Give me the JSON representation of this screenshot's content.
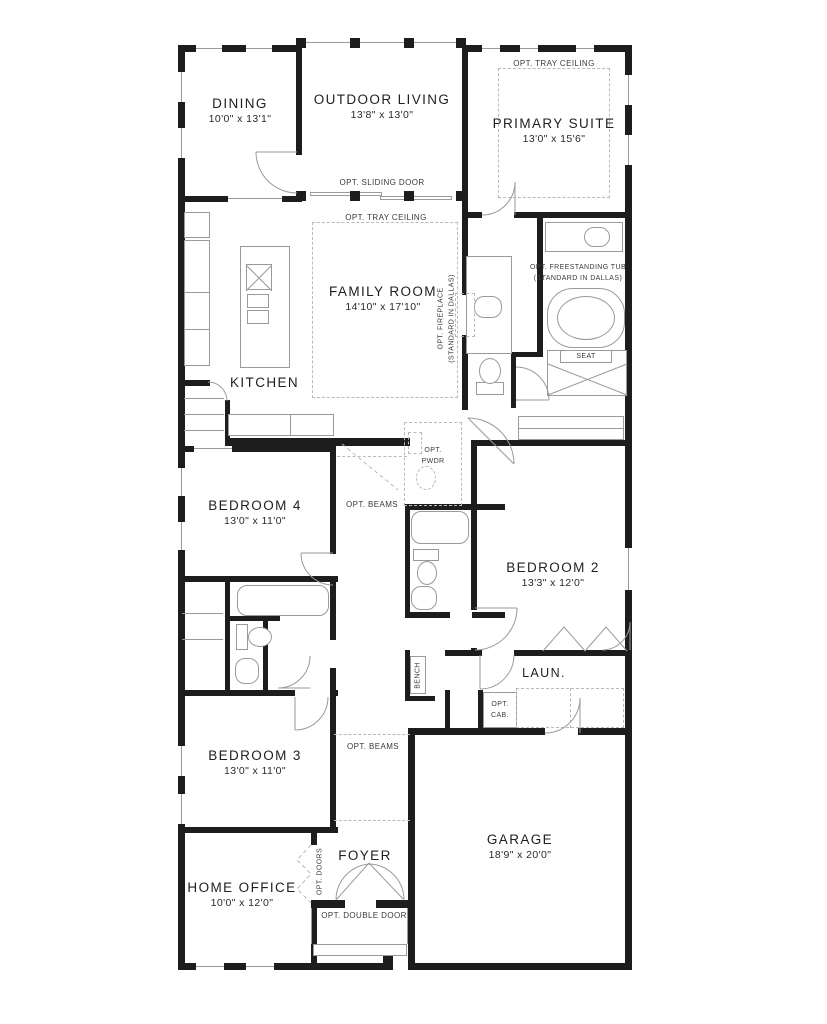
{
  "plan": {
    "rooms": {
      "dining": {
        "name": "DINING",
        "dims": "10'0\" x 13'1\""
      },
      "outdoor_living": {
        "name": "OUTDOOR LIVING",
        "dims": "13'8\" x 13'0\""
      },
      "primary_suite": {
        "name": "PRIMARY SUITE",
        "dims": "13'0\" x 15'6\""
      },
      "family_room": {
        "name": "FAMILY ROOM",
        "dims": "14'10\" x 17'10\""
      },
      "kitchen": {
        "name": "KITCHEN"
      },
      "bedroom4": {
        "name": "BEDROOM 4",
        "dims": "13'0\" x 11'0\""
      },
      "bedroom2": {
        "name": "BEDROOM 2",
        "dims": "13'3\" x 12'0\""
      },
      "bedroom3": {
        "name": "BEDROOM 3",
        "dims": "13'0\" x 11'0\""
      },
      "laundry": {
        "name": "LAUN."
      },
      "foyer": {
        "name": "FOYER"
      },
      "home_office": {
        "name": "HOME OFFICE",
        "dims": "10'0\" x 12'0\""
      },
      "garage": {
        "name": "GARAGE",
        "dims": "18'9\" x 20'0\""
      }
    },
    "annotations": {
      "tray_primary": "OPT. TRAY CEILING",
      "tray_family": "OPT. TRAY CEILING",
      "sliding_door": "OPT. SLIDING DOOR",
      "fireplace_line1": "OPT. FIREPLACE",
      "fireplace_line2": "(STANDARD IN DALLAS)",
      "tub_line1": "OPT. FREESTANDING TUB",
      "tub_line2": "(STANDARD IN DALLAS)",
      "seat": "SEAT",
      "pwdr_line1": "OPT.",
      "pwdr_line2": "PWDR",
      "beams_upper": "OPT. BEAMS",
      "beams_lower": "OPT. BEAMS",
      "bench": "BENCH",
      "cab_line1": "OPT.",
      "cab_line2": "CAB.",
      "doors": "OPT. DOORS",
      "double_door": "OPT. DOUBLE DOOR"
    },
    "colors": {
      "wall": "#1d1d1d",
      "line": "#9a9a9a",
      "dash": "#b9b9b9",
      "text": "#2a2a2a",
      "bg": "#ffffff"
    }
  }
}
